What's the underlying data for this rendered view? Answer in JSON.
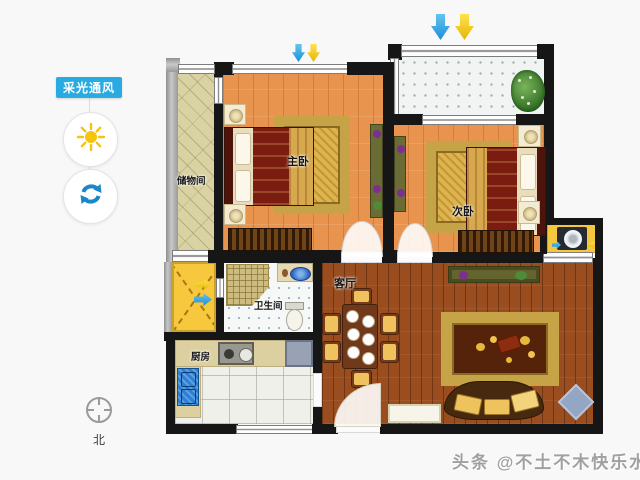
{
  "window": {
    "width": 640,
    "height": 480,
    "background": "#f8f8f8"
  },
  "sidebar": {
    "toggle_label": "采光通风",
    "toggle_color": "#29abe2",
    "buttons": [
      {
        "id": "daylight",
        "icon": "sun-icon",
        "icon_color": "#f6c40f"
      },
      {
        "id": "ventilation",
        "icon": "refresh-icon",
        "icon_color": "#1b87c9"
      }
    ]
  },
  "floorplan": {
    "rooms": [
      {
        "id": "storage",
        "label": "储物间"
      },
      {
        "id": "master-bedroom",
        "label": "主卧"
      },
      {
        "id": "second-bedroom",
        "label": "次卧"
      },
      {
        "id": "bathroom",
        "label": "卫生间"
      },
      {
        "id": "kitchen",
        "label": "厨房"
      },
      {
        "id": "living-room",
        "label": "客厅"
      }
    ],
    "light_arrows": {
      "colors": [
        "#2fa8e8",
        "#f7d020"
      ],
      "direction": "down"
    },
    "shaft_arrows": {
      "colors": [
        "#f7d020",
        "#2fa8e8"
      ],
      "direction": "right"
    }
  },
  "compass": {
    "label": "北"
  },
  "watermark": {
    "text": "头条 @不土不木快乐水"
  },
  "colors": {
    "wall": "#161616",
    "wood_light": "#e8944e",
    "wood_dark": "#9a4d1e",
    "storage_floor": "#d9d2a3",
    "shaft_yellow": "#f7c83d",
    "accent_blue": "#29abe2"
  }
}
